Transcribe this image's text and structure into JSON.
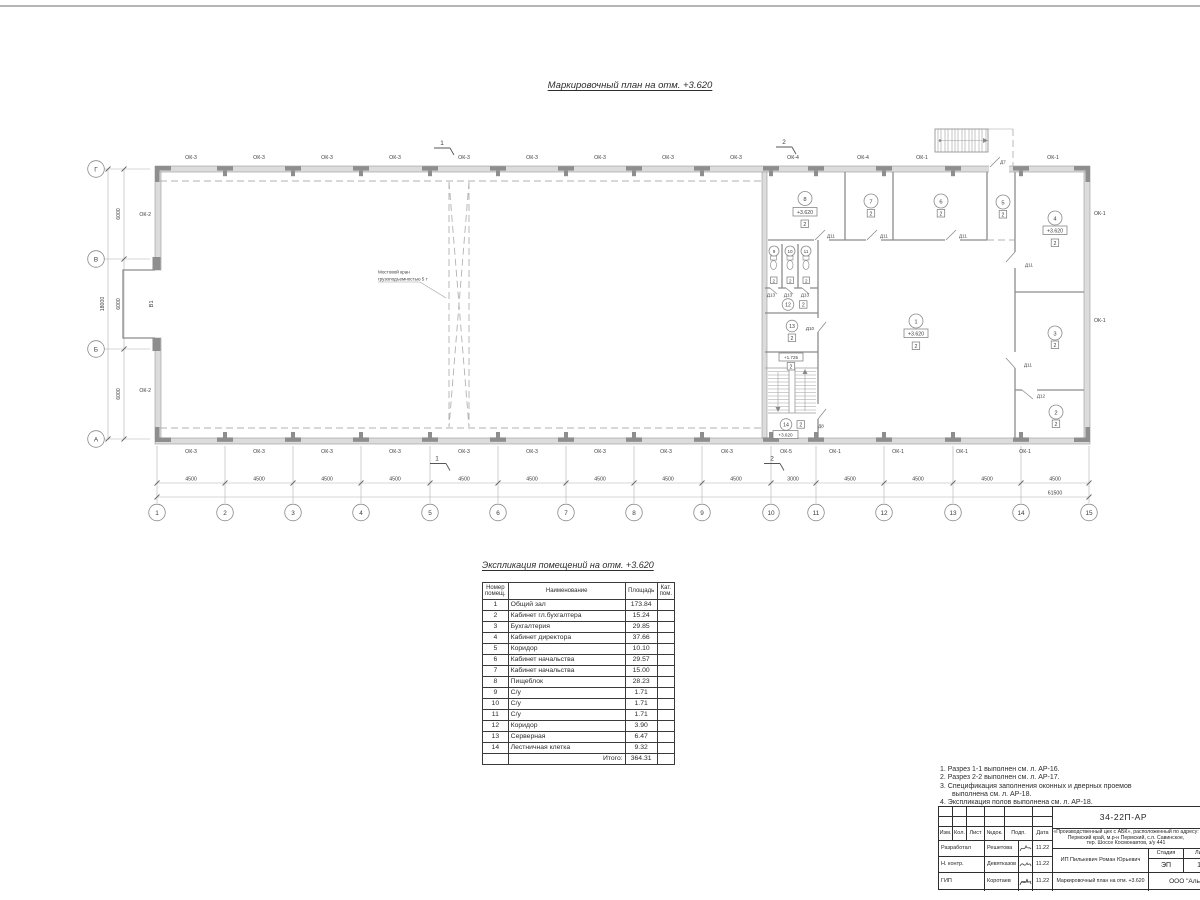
{
  "page": {
    "plan_title": "Маркировочный план  на отм. +3.620"
  },
  "plan": {
    "grid_cols": [
      "1",
      "2",
      "3",
      "4",
      "5",
      "6",
      "7",
      "8",
      "9",
      "10",
      "11",
      "12",
      "13",
      "14",
      "15"
    ],
    "grid_rows": [
      "Г",
      "В",
      "Б",
      "А"
    ],
    "windows": {
      "ok1": "ОК-1",
      "ok2": "ОК-2",
      "ok3": "ОК-3",
      "ok4": "ОК-4",
      "ok5": "ОК-5"
    },
    "doors": {
      "d7": "Д7",
      "d8": "Д8",
      "d10": "Д10",
      "d11": "Д11",
      "d12": "Д12",
      "d13": "Д13"
    },
    "levels": {
      "l3620": "+3.620",
      "l1725": "+1.725"
    },
    "category": "2",
    "gate_label": "В1",
    "room_numbers": [
      "1",
      "2",
      "3",
      "4",
      "5",
      "6",
      "7",
      "8",
      "9",
      "10",
      "11",
      "12",
      "13",
      "14"
    ],
    "crane_note": [
      "Мостовой кран",
      "грузоподъемностью 5 т"
    ],
    "sections": {
      "s1": "1",
      "s2": "2"
    },
    "dims": {
      "bay": "4500",
      "bay_small": "3000",
      "row": "6000",
      "row_total": "18000",
      "total": "61500"
    }
  },
  "schedule": {
    "title": "Экспликация помещений на отм. +3.620",
    "headers": {
      "num1": "Номер",
      "num2": "помещ.",
      "name": "Наименование",
      "area": "Площадь",
      "cat1": "Кат.",
      "cat2": "пом."
    },
    "rows": [
      {
        "num": "1",
        "name": "Общий зал",
        "area": "173.84"
      },
      {
        "num": "2",
        "name": "Кабинет гл.бухгалтера",
        "area": "15.24"
      },
      {
        "num": "3",
        "name": "Бухгалтерия",
        "area": "29.85"
      },
      {
        "num": "4",
        "name": "Кабинет директора",
        "area": "37.66"
      },
      {
        "num": "5",
        "name": "Коридор",
        "area": "10.10"
      },
      {
        "num": "6",
        "name": "Кабинет начальства",
        "area": "29.57"
      },
      {
        "num": "7",
        "name": "Кабинет начальства",
        "area": "15.00"
      },
      {
        "num": "8",
        "name": "Пищеблок",
        "area": "28.23"
      },
      {
        "num": "9",
        "name": "С/у",
        "area": "1.71"
      },
      {
        "num": "10",
        "name": "С/у",
        "area": "1.71"
      },
      {
        "num": "11",
        "name": "С/у",
        "area": "1.71"
      },
      {
        "num": "12",
        "name": "Коридор",
        "area": "3.90"
      },
      {
        "num": "13",
        "name": "Серверная",
        "area": "6.47"
      },
      {
        "num": "14",
        "name": "Лестничная клетка",
        "area": "9.32"
      }
    ],
    "total_label": "Итого:",
    "total_area": "364.31"
  },
  "notes": {
    "items": [
      "1. Разрез 1-1 выполнен см. л. АР-16.",
      "2. Разрез 2-2 выполнен см. л. АР-17.",
      "3. Спецификация заполнения оконных и дверных проемов выполнена см. л. АР-18.",
      "4. Экспликация полов выполнена см. л. АР-18."
    ]
  },
  "stamp": {
    "code": "34-22П-АР",
    "project": [
      "«Производственный цех с АБК», расположенный по адресу:",
      "Пермский край, м.р-н Пермский, с.п. Савинское,",
      "тер. Шоссе Космонавтов, з/у 441"
    ],
    "cols": {
      "izm": "Изм.",
      "kol": "Кол.",
      "list": "Лист",
      "ndoc": "№док.",
      "podp": "Подп.",
      "data": "Дата"
    },
    "rows": [
      {
        "role": "Разработал",
        "name": "Решетова",
        "date": "11.22"
      },
      {
        "role": "Н. контр.",
        "name": "Девятказов",
        "date": "11.22"
      },
      {
        "role": "ГИП",
        "name": "Коротаев",
        "date": "11.22"
      }
    ],
    "client": "ИП Пилькевич Роман Юрьевич",
    "stage_label": "Стадия",
    "sheet_label": "Лист",
    "stage": "ЭП",
    "sheet": "13",
    "drawing_title": "Маркировочный план на отм. +3.620",
    "company": "ООО \"Альфа"
  }
}
